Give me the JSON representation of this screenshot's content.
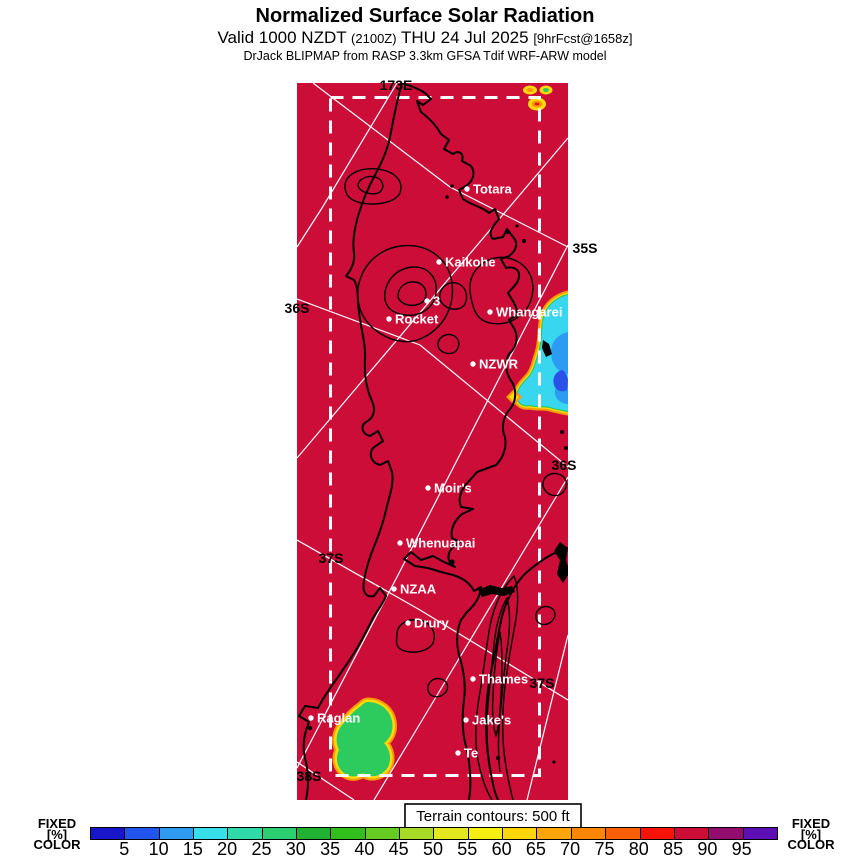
{
  "header": {
    "title": "Normalized Surface Solar Radiation",
    "subtitle_main": "Valid 1000 NZDT",
    "subtitle_zulu": "(2100Z)",
    "subtitle_date": "THU 24 Jul 2025",
    "subtitle_fcst": "[9hrFcst@1658z]",
    "model_line": "DrJack BLIPMAP from RASP 3.3km GFSA Tdif WRF-ARW model"
  },
  "map": {
    "terrain_note": "Terrain contours: 500 ft",
    "colors": {
      "map_red": "#cb0d38",
      "cloud_cyan": "#38d7ef",
      "cloud_blue_mid": "#2b9cf2",
      "cloud_blue_deep": "#2a52e8",
      "ring_green": "#2dca5e",
      "ring_yellow": "#ffd90a",
      "ring_orange": "#ff9806",
      "graticule_white": "#ffffff",
      "coast_black": "#000000"
    },
    "graticule_labels": [
      {
        "text": "173E",
        "x": 396,
        "y": 90
      },
      {
        "text": "35S",
        "x": 585,
        "y": 253
      },
      {
        "text": "36S",
        "x": 297,
        "y": 313
      },
      {
        "text": "36S",
        "x": 564,
        "y": 470
      },
      {
        "text": "37S",
        "x": 331,
        "y": 563
      },
      {
        "text": "37S",
        "x": 542,
        "y": 688
      },
      {
        "text": "38S",
        "x": 309,
        "y": 781
      }
    ],
    "stations": [
      {
        "name": "Totara",
        "x": 467,
        "y": 189
      },
      {
        "name": "Kaikohe",
        "x": 439,
        "y": 262
      },
      {
        "name": "3",
        "x": 427,
        "y": 301
      },
      {
        "name": "Rocket",
        "x": 389,
        "y": 319
      },
      {
        "name": "Whangarei",
        "x": 490,
        "y": 312
      },
      {
        "name": "NZWR",
        "x": 473,
        "y": 364
      },
      {
        "name": "Moir's",
        "x": 428,
        "y": 488
      },
      {
        "name": "Whenuapai",
        "x": 400,
        "y": 543
      },
      {
        "name": "NZAA",
        "x": 394,
        "y": 589
      },
      {
        "name": "Drury",
        "x": 408,
        "y": 623
      },
      {
        "name": "Thames",
        "x": 473,
        "y": 679
      },
      {
        "name": "Jake's",
        "x": 466,
        "y": 720
      },
      {
        "name": "Te",
        "x": 458,
        "y": 753
      },
      {
        "name": "Raglan",
        "x": 311,
        "y": 718
      }
    ]
  },
  "colorbar": {
    "left_label_lines": [
      "FIXED",
      "[%]",
      "COLOR"
    ],
    "right_label_lines": [
      "FIXED",
      "[%]",
      "COLOR"
    ],
    "unit": "%",
    "tick_values": [
      5,
      10,
      15,
      20,
      25,
      30,
      35,
      40,
      45,
      50,
      55,
      60,
      65,
      70,
      75,
      80,
      85,
      90,
      95
    ],
    "segment_colors": [
      "#1717c9",
      "#2255ee",
      "#2e9bf0",
      "#38dfe8",
      "#2fd9a8",
      "#2bcf71",
      "#21b233",
      "#32bf1d",
      "#66cc22",
      "#a9da28",
      "#e3e81f",
      "#f8ef12",
      "#ffd60a",
      "#ffa70a",
      "#fb8604",
      "#f95f06",
      "#f8130a",
      "#cb0d38",
      "#930d6e",
      "#5c0fb5"
    ]
  }
}
